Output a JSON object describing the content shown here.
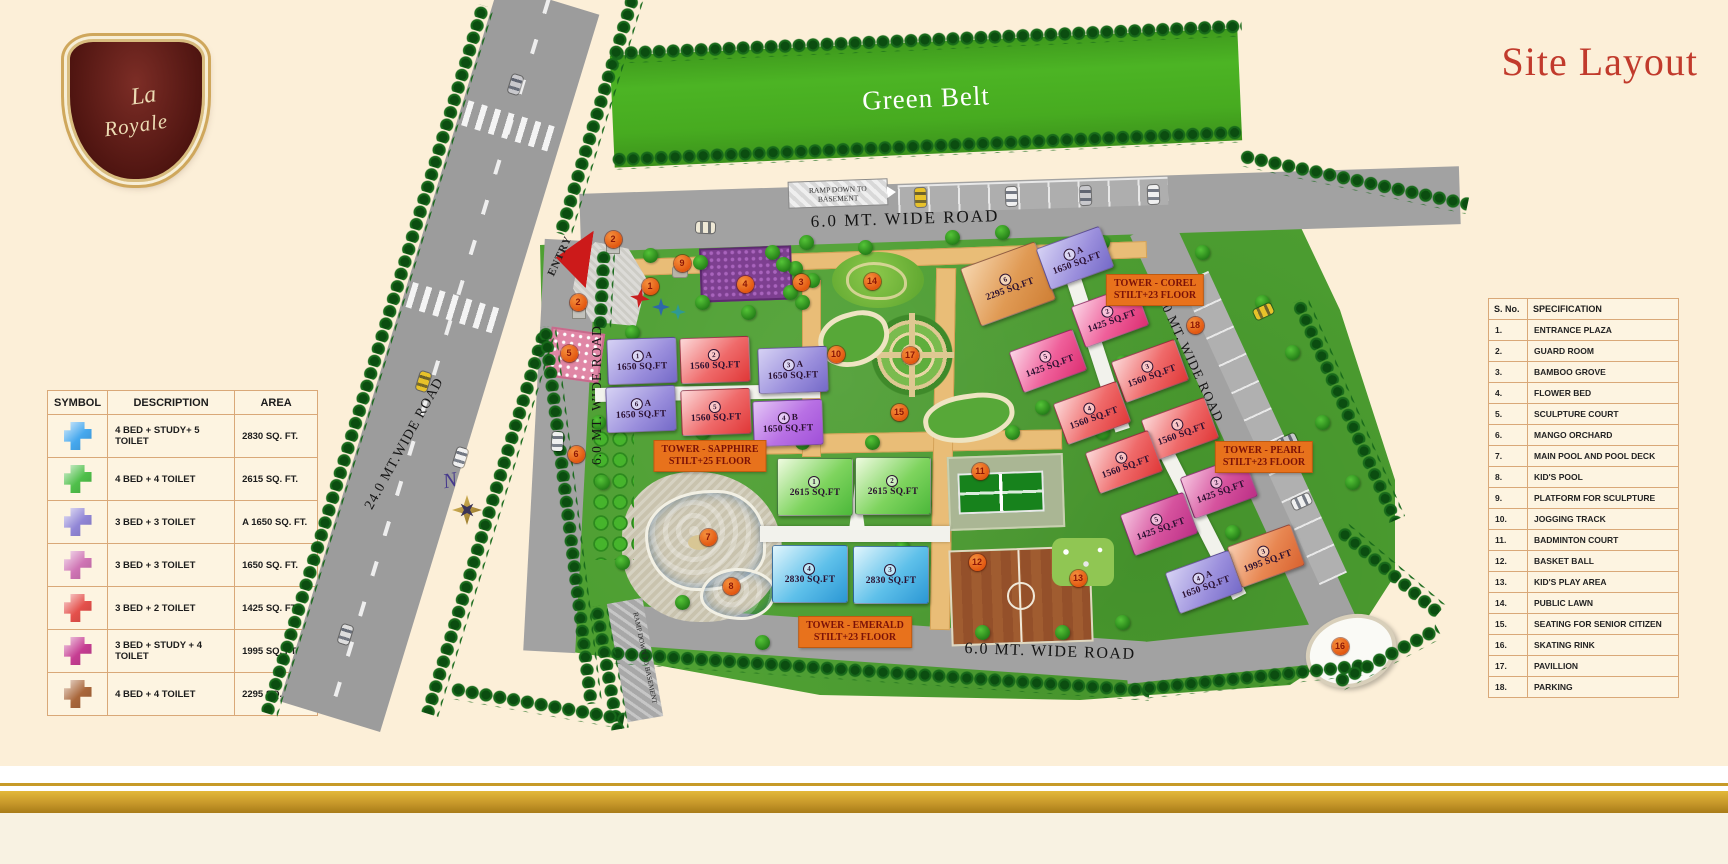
{
  "title": "Site Layout",
  "brand": {
    "line1": "La",
    "line2": "Royale"
  },
  "legend_table": {
    "headers": [
      "SYMBOL",
      "DESCRIPTION",
      "AREA"
    ],
    "rows": [
      {
        "color": "#45a8ee",
        "description": "4 BED + STUDY+ 5 TOILET",
        "area": "2830 SQ. FT."
      },
      {
        "color": "#4fbf4a",
        "description": "4 BED + 4 TOILET",
        "area": "2615 SQ. FT."
      },
      {
        "color": "#9186d6",
        "description": "3 BED + 3 TOILET",
        "area": "A 1650 SQ. FT."
      },
      {
        "color": "#cf74b4",
        "description": "3 BED + 3 TOILET",
        "area": "1650 SQ. FT."
      },
      {
        "color": "#e4504b",
        "description": "3 BED + 2 TOILET",
        "area": "1425 SQ. FT."
      },
      {
        "color": "#c63d92",
        "description": "3 BED + STUDY + 4 TOILET",
        "area": "1995 SQ. FT."
      },
      {
        "color": "#a9663a",
        "description": "4 BED + 4 TOILET",
        "area": "2295 SQ. FT."
      }
    ]
  },
  "spec_table": {
    "headers": [
      "S. No.",
      "SPECIFICATION"
    ],
    "rows": [
      [
        "1.",
        "ENTRANCE PLAZA"
      ],
      [
        "2.",
        "GUARD ROOM"
      ],
      [
        "3.",
        "BAMBOO GROVE"
      ],
      [
        "4.",
        "FLOWER BED"
      ],
      [
        "5.",
        "SCULPTURE COURT"
      ],
      [
        "6.",
        "MANGO ORCHARD"
      ],
      [
        "7.",
        "MAIN POOL AND POOL DECK"
      ],
      [
        "8.",
        "KID'S POOL"
      ],
      [
        "9.",
        "PLATFORM FOR SCULPTURE"
      ],
      [
        "10.",
        "JOGGING TRACK"
      ],
      [
        "11.",
        "BADMINTON COURT"
      ],
      [
        "12.",
        "BASKET BALL"
      ],
      [
        "13.",
        "KID'S PLAY AREA"
      ],
      [
        "14.",
        "PUBLIC LAWN"
      ],
      [
        "15.",
        "SEATING FOR SENIOR CITIZEN"
      ],
      [
        "16.",
        "SKATING RINK"
      ],
      [
        "17.",
        "PAVILLION"
      ],
      [
        "18.",
        "PARKING"
      ]
    ]
  },
  "map": {
    "green_belt": "Green Belt",
    "entry": "ENTRY",
    "compass": "N",
    "ramp_top": "RAMP DOWN TO BASEMENT",
    "ramp_bottom": "RAMP DOWN TO BASEMENT",
    "roads": {
      "top": "6.0 MT. WIDE ROAD",
      "left": "6.0 MT. WIDE ROAD",
      "main": "24.0 MT.WIDE ROAD",
      "right": "6.0 MT. WIDE ROAD",
      "bottom": "6.0 MT. WIDE ROAD"
    },
    "towers": [
      {
        "name": "TOWER - SAPPHIRE",
        "floors": "STILT+25 FLOOR",
        "lx": 710,
        "ly": 456,
        "units": [
          {
            "n": "1",
            "s": "A",
            "area": "1650 SQ.FT",
            "c": "violet",
            "x": 642,
            "y": 361,
            "r": -2
          },
          {
            "n": "2",
            "s": "",
            "area": "1560 SQ.FT",
            "c": "red",
            "x": 715,
            "y": 360,
            "r": -2
          },
          {
            "n": "3",
            "s": "A",
            "area": "1650 SQ.FT",
            "c": "violet",
            "x": 793,
            "y": 370,
            "r": -2
          },
          {
            "n": "6",
            "s": "A",
            "area": "1650 SQ.FT",
            "c": "violet",
            "x": 641,
            "y": 409,
            "r": -2
          },
          {
            "n": "5",
            "s": "",
            "area": "1560 SQ.FT",
            "c": "red",
            "x": 716,
            "y": 412,
            "r": -2
          },
          {
            "n": "4",
            "s": "B",
            "area": "1650 SQ.FT",
            "c": "purple",
            "x": 788,
            "y": 423,
            "r": -2
          }
        ]
      },
      {
        "name": "TOWER - EMERALD",
        "floors": "STILT+23 FLOOR",
        "lx": 855,
        "ly": 632,
        "units": [
          {
            "n": "1",
            "s": "",
            "area": "2615 SQ.FT",
            "c": "green",
            "x": 815,
            "y": 487,
            "r": 0,
            "w": 74,
            "h": 56
          },
          {
            "n": "2",
            "s": "",
            "area": "2615 SQ.FT",
            "c": "green",
            "x": 893,
            "y": 486,
            "r": 0,
            "w": 74,
            "h": 56
          },
          {
            "n": "4",
            "s": "",
            "area": "2830 SQ.FT",
            "c": "blue",
            "x": 810,
            "y": 574,
            "r": 0,
            "w": 74,
            "h": 56
          },
          {
            "n": "3",
            "s": "",
            "area": "2830 SQ.FT",
            "c": "blue",
            "x": 891,
            "y": 575,
            "r": 0,
            "w": 74,
            "h": 56
          }
        ]
      },
      {
        "name": "TOWER - COREL",
        "floors": "STILT+23 FLOOR",
        "lx": 1155,
        "ly": 290,
        "units": [
          {
            "n": "6",
            "s": "",
            "area": "2295 SQ.FT",
            "c": "orange",
            "x": 1008,
            "y": 284,
            "r": -20,
            "w": 78,
            "h": 60
          },
          {
            "n": "1",
            "s": "A",
            "area": "1650 SQ.FT",
            "c": "violet",
            "x": 1075,
            "y": 258,
            "r": -20,
            "w": 66,
            "h": 42
          },
          {
            "n": "2",
            "s": "",
            "area": "1425 SQ.FT",
            "c": "pink",
            "x": 1110,
            "y": 316,
            "r": -20,
            "w": 66,
            "h": 42
          },
          {
            "n": "5",
            "s": "",
            "area": "1425 SQ.FT",
            "c": "pink",
            "x": 1048,
            "y": 361,
            "r": -20,
            "w": 66,
            "h": 42
          },
          {
            "n": "3",
            "s": "",
            "area": "1560 SQ.FT",
            "c": "red",
            "x": 1150,
            "y": 371,
            "r": -20,
            "w": 66,
            "h": 42
          },
          {
            "n": "4",
            "s": "",
            "area": "1560 SQ.FT",
            "c": "red",
            "x": 1092,
            "y": 413,
            "r": -20,
            "w": 66,
            "h": 42
          }
        ]
      },
      {
        "name": "TOWER - PEARL",
        "floors": "STILT+23 FLOOR",
        "lx": 1264,
        "ly": 457,
        "units": [
          {
            "n": "1",
            "s": "",
            "area": "1560 SQ.FT",
            "c": "red",
            "x": 1180,
            "y": 429,
            "r": -20,
            "w": 66,
            "h": 42
          },
          {
            "n": "6",
            "s": "",
            "area": "1560 SQ.FT",
            "c": "red",
            "x": 1124,
            "y": 462,
            "r": -20,
            "w": 66,
            "h": 42
          },
          {
            "n": "2",
            "s": "",
            "area": "1425 SQ.FT",
            "c": "magenta",
            "x": 1219,
            "y": 487,
            "r": -20,
            "w": 66,
            "h": 42
          },
          {
            "n": "5",
            "s": "",
            "area": "1425 SQ.FT",
            "c": "magenta",
            "x": 1159,
            "y": 524,
            "r": -20,
            "w": 66,
            "h": 42
          },
          {
            "n": "3",
            "s": "",
            "area": "1995 SQ.FT",
            "c": "salmon",
            "x": 1266,
            "y": 556,
            "r": -20,
            "w": 66,
            "h": 42
          },
          {
            "n": "4",
            "s": "A",
            "area": "1650 SQ.FT",
            "c": "violet",
            "x": 1204,
            "y": 582,
            "r": -20,
            "w": 66,
            "h": 42
          }
        ]
      }
    ],
    "markers": [
      {
        "n": "1",
        "x": 650,
        "y": 286
      },
      {
        "n": "2",
        "x": 613,
        "y": 239
      },
      {
        "n": "2",
        "x": 578,
        "y": 302
      },
      {
        "n": "3",
        "x": 801,
        "y": 282
      },
      {
        "n": "4",
        "x": 745,
        "y": 284
      },
      {
        "n": "5",
        "x": 569,
        "y": 353
      },
      {
        "n": "6",
        "x": 576,
        "y": 454
      },
      {
        "n": "7",
        "x": 708,
        "y": 537
      },
      {
        "n": "8",
        "x": 731,
        "y": 586
      },
      {
        "n": "9",
        "x": 682,
        "y": 263
      },
      {
        "n": "10",
        "x": 836,
        "y": 354
      },
      {
        "n": "11",
        "x": 980,
        "y": 471
      },
      {
        "n": "12",
        "x": 977,
        "y": 562
      },
      {
        "n": "13",
        "x": 1078,
        "y": 578
      },
      {
        "n": "14",
        "x": 872,
        "y": 281
      },
      {
        "n": "15",
        "x": 899,
        "y": 412
      },
      {
        "n": "16",
        "x": 1340,
        "y": 646
      },
      {
        "n": "17",
        "x": 910,
        "y": 355
      },
      {
        "n": "18",
        "x": 1195,
        "y": 325
      }
    ]
  }
}
